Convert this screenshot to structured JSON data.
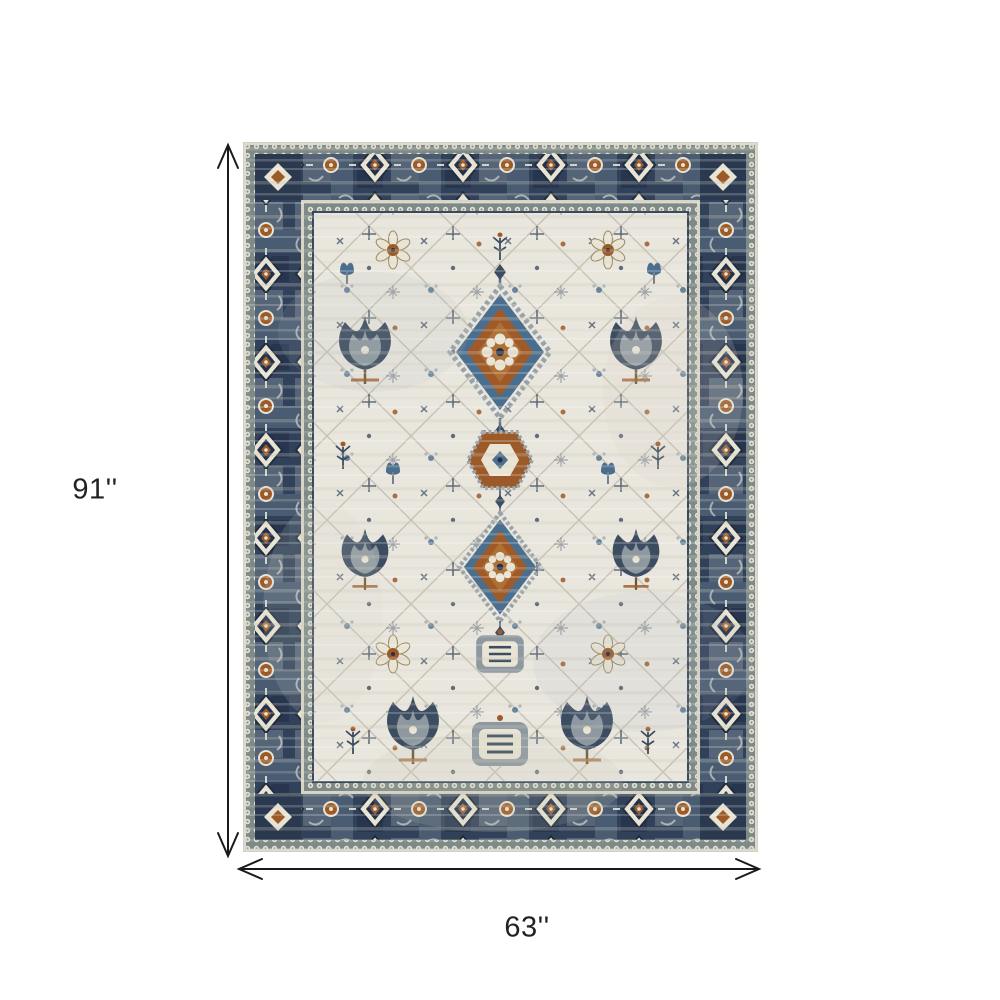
{
  "page": {
    "background": "#ffffff"
  },
  "figure": {
    "subject": "distressed-oriental-area-rug",
    "dimension_height": {
      "label": "91''"
    },
    "dimension_width": {
      "label": "63''"
    },
    "colors": {
      "arrow": "#1a1a1a",
      "label_text": "#222222",
      "rug_field_ivory": "#e9e6de",
      "rug_border_navy": "#31415a",
      "rug_slate_blue": "#5d7285",
      "rug_steel_blue": "#4a6e8e",
      "rug_rust": "#9c5a28",
      "rug_cream": "#e8e3d2",
      "rug_dark_navy": "#22304a",
      "rug_vine_gray": "#c6c2b3"
    }
  }
}
